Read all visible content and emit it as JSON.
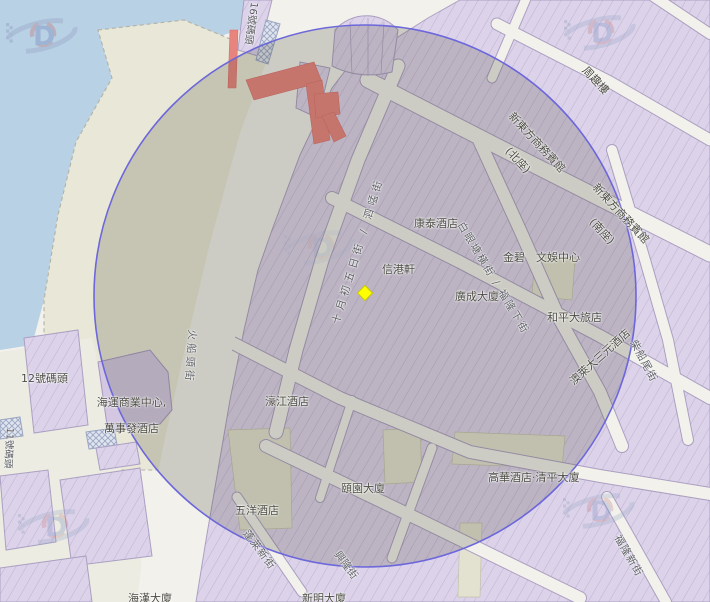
{
  "map": {
    "marker": {
      "name": "selected-location",
      "shape": "diamond",
      "color": "#ffff00"
    },
    "radius_overlay": {
      "shape": "circle",
      "stroke_color": "#6c67da",
      "fill_tint": "dark-translucent"
    },
    "colors": {
      "water": "#b8d1e5",
      "building": "#dcd3ea",
      "road": "#f2f1ec",
      "pier_deck": "#e9e8d8",
      "closed_road_red": "#e8847e",
      "marker_yellow": "#ffff00",
      "circle_stroke": "#6c67da"
    },
    "watermark_letter": "D"
  },
  "labels": {
    "streets": [
      {
        "text": "十月初五日街 / 泗𠵼街"
      },
      {
        "text": "白眼塘橫街 / 福隆下街"
      },
      {
        "text": "火船頭街"
      },
      {
        "text": "蓬萊新街"
      },
      {
        "text": "福隆新街"
      },
      {
        "text": "柴船尾街"
      },
      {
        "text": "興隆街"
      }
    ],
    "places": [
      {
        "text": "康泰酒店"
      },
      {
        "text": "信港軒"
      },
      {
        "text": "金碧　文娛中心"
      },
      {
        "text": "廣成大廈"
      },
      {
        "text": "和平大旅店"
      },
      {
        "text": "澳萊大三元酒店"
      },
      {
        "text": "濠江酒店"
      },
      {
        "text": "頤園大廈"
      },
      {
        "text": "五洋酒店"
      },
      {
        "text": "高華酒店‧清平大廈"
      },
      {
        "text": "周趣樓"
      },
      {
        "text": "新東方商務賓館"
      },
      {
        "text": "(北座)"
      },
      {
        "text": "新東方商務賓館"
      },
      {
        "text": "(南座)"
      },
      {
        "text": "新明大廈"
      },
      {
        "text": "海漢大廈"
      },
      {
        "text": "海運商業中心,"
      },
      {
        "text": "萬事發酒店"
      }
    ],
    "piers": [
      {
        "text": "16號碼頭"
      },
      {
        "text": "12號碼頭"
      },
      {
        "text": "11號碼頭"
      }
    ]
  }
}
